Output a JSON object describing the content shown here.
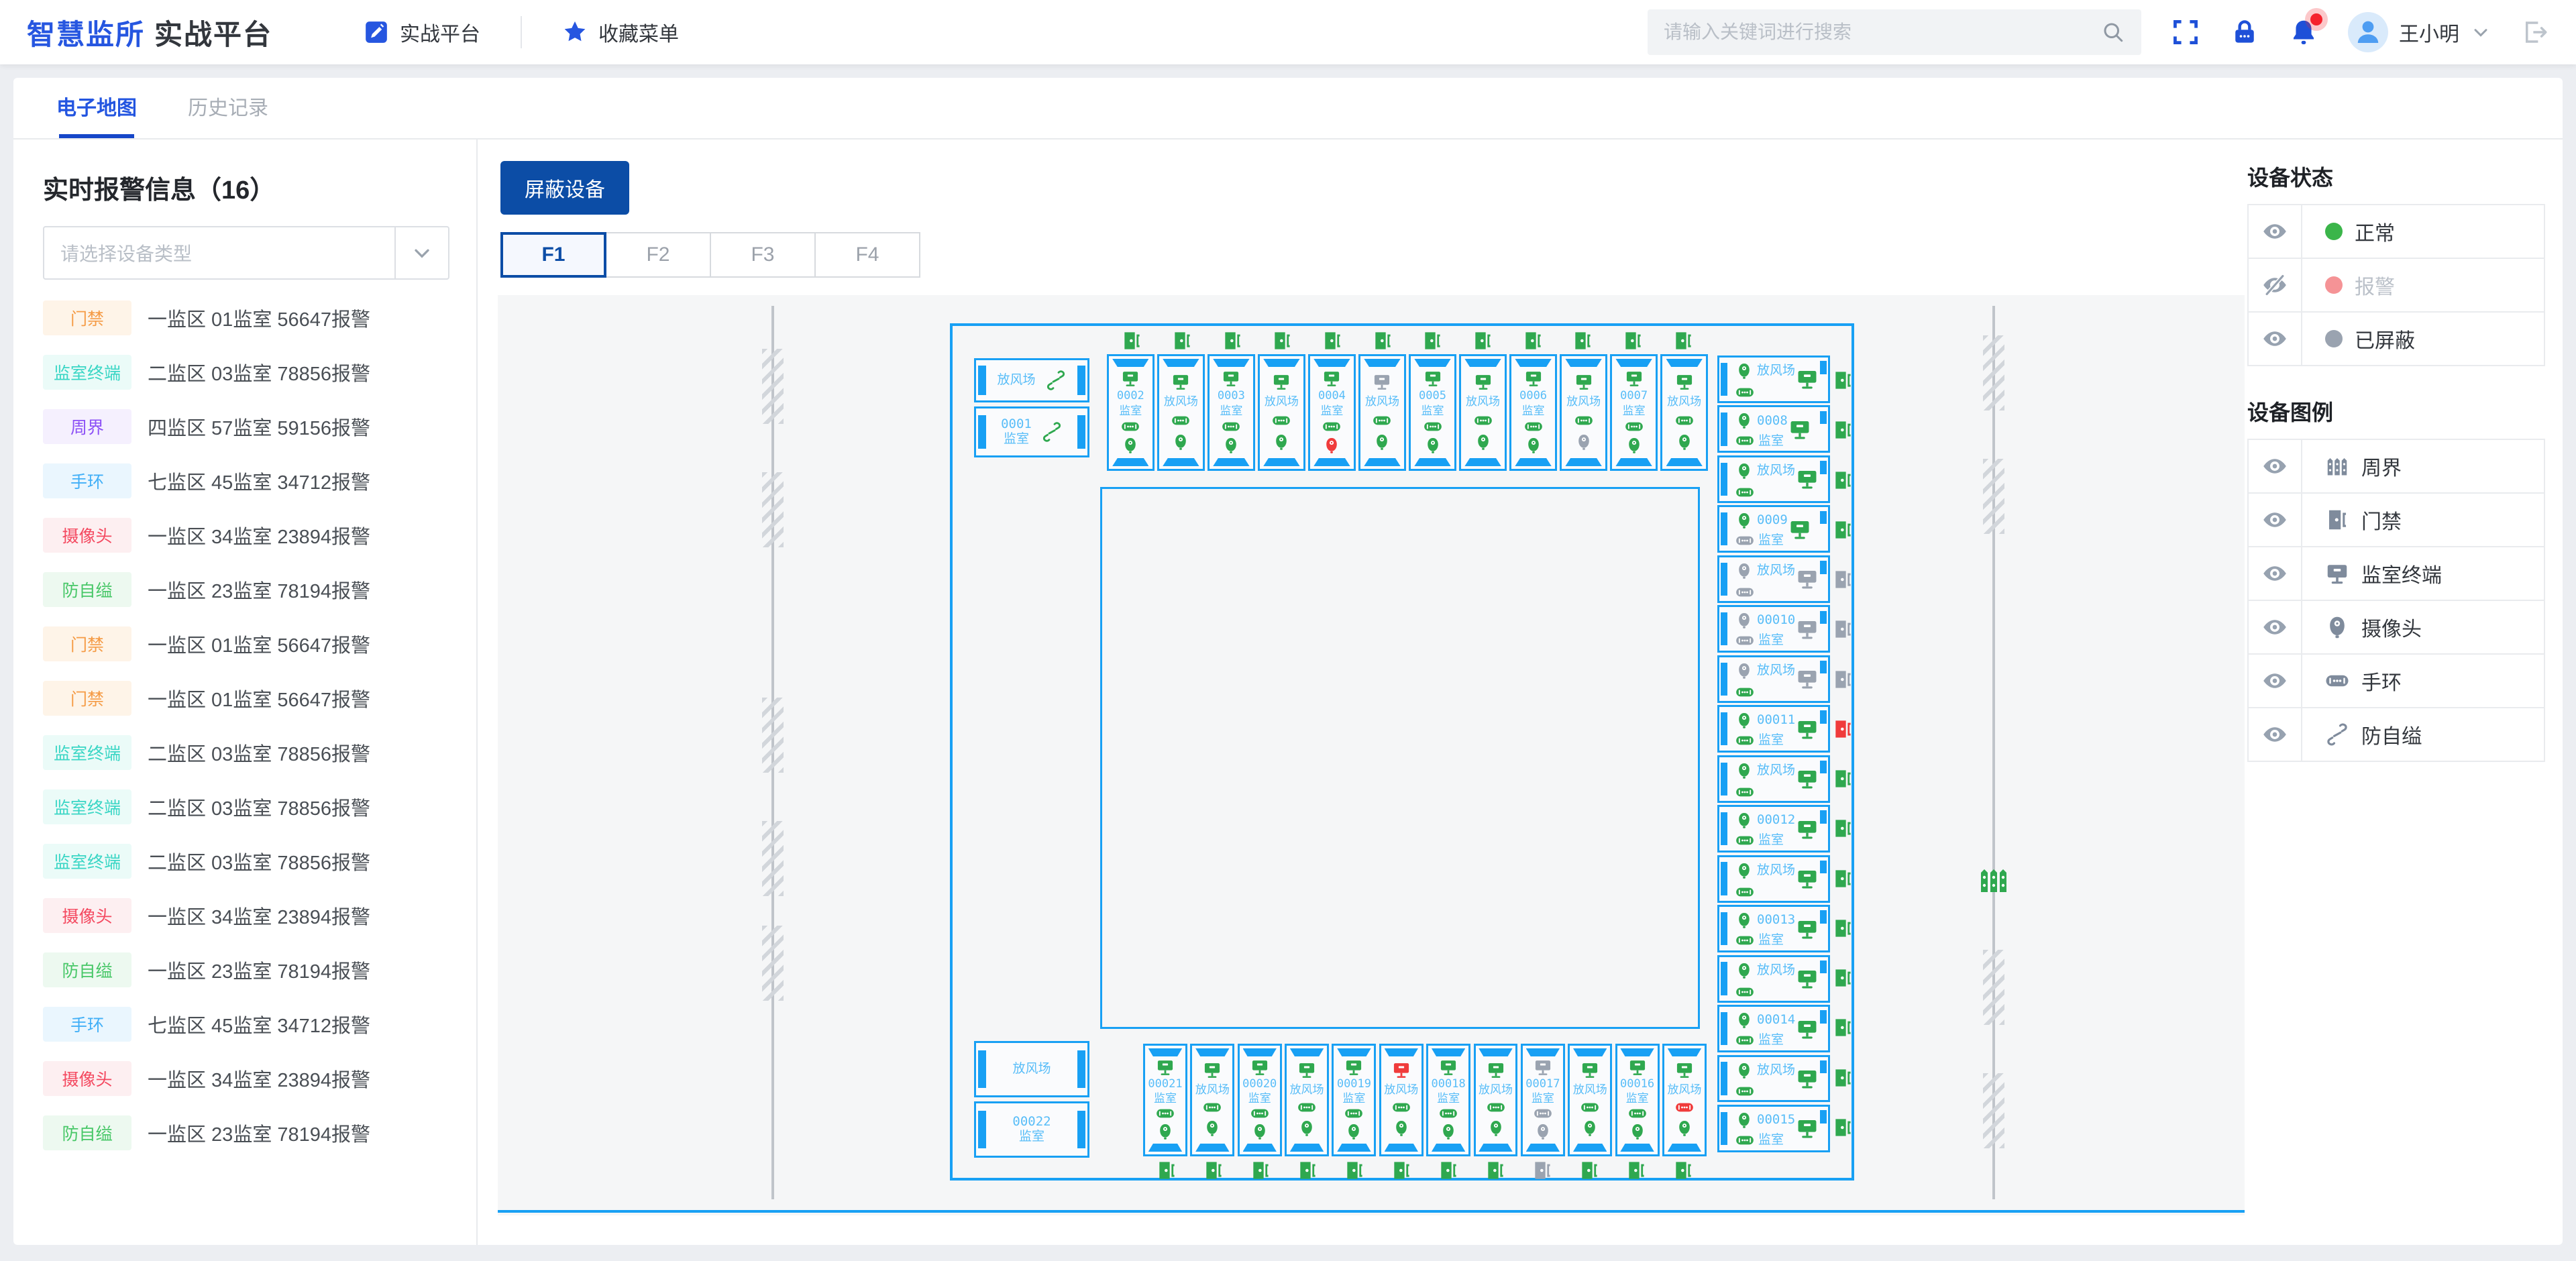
{
  "navbar": {
    "logo_primary": "智慧监所",
    "logo_secondary": "实战平台",
    "menu": [
      {
        "label": "实战平台",
        "icon": "edit-icon"
      },
      {
        "label": "收藏菜单",
        "icon": "star-icon"
      }
    ],
    "search_placeholder": "请输入关键词进行搜索",
    "user_name": "王小明"
  },
  "tabs": [
    {
      "label": "电子地图",
      "active": true
    },
    {
      "label": "历史记录",
      "active": false
    }
  ],
  "sidebar": {
    "title": "实时报警信息（16）",
    "count": 16,
    "filter_placeholder": "请选择设备类型",
    "alarms": [
      {
        "type": "门禁",
        "fg": "#F59B45",
        "bg": "#FEF4E8",
        "text": "一监区 01监室 56647报警"
      },
      {
        "type": "监室终端",
        "fg": "#3AD6C5",
        "bg": "#EBFBF8",
        "text": "二监区 03监室 78856报警"
      },
      {
        "type": "周界",
        "fg": "#8C50F6",
        "bg": "#F5F0FE",
        "text": "四监区 57监室 59156报警"
      },
      {
        "type": "手环",
        "fg": "#41AFF7",
        "bg": "#EAF6FE",
        "text": "七监区 45监室 34712报警"
      },
      {
        "type": "摄像头",
        "fg": "#F4485F",
        "bg": "#FDEFF1",
        "text": "一监区 34监室 23894报警"
      },
      {
        "type": "防自缢",
        "fg": "#47C767",
        "bg": "#EDF9F0",
        "text": "一监区 23监室 78194报警"
      },
      {
        "type": "门禁",
        "fg": "#F59B45",
        "bg": "#FEF4E8",
        "text": "一监区 01监室 56647报警"
      },
      {
        "type": "门禁",
        "fg": "#F59B45",
        "bg": "#FEF4E8",
        "text": "一监区 01监室 56647报警"
      },
      {
        "type": "监室终端",
        "fg": "#3AD6C5",
        "bg": "#EBFBF8",
        "text": "二监区 03监室 78856报警"
      },
      {
        "type": "监室终端",
        "fg": "#3AD6C5",
        "bg": "#EBFBF8",
        "text": "二监区 03监室 78856报警"
      },
      {
        "type": "监室终端",
        "fg": "#3AD6C5",
        "bg": "#EBFBF8",
        "text": "二监区 03监室 78856报警"
      },
      {
        "type": "摄像头",
        "fg": "#F4485F",
        "bg": "#FDEFF1",
        "text": "一监区 34监室 23894报警"
      },
      {
        "type": "防自缢",
        "fg": "#47C767",
        "bg": "#EDF9F0",
        "text": "一监区 23监室 78194报警"
      },
      {
        "type": "手环",
        "fg": "#41AFF7",
        "bg": "#EAF6FE",
        "text": "七监区 45监室 34712报警"
      },
      {
        "type": "摄像头",
        "fg": "#F4485F",
        "bg": "#FDEFF1",
        "text": "一监区 34监室 23894报警"
      },
      {
        "type": "防自缢",
        "fg": "#47C767",
        "bg": "#EDF9F0",
        "text": "一监区 23监室 78194报警"
      }
    ]
  },
  "toolbar": {
    "shield_button": "屏蔽设备",
    "floors": [
      "F1",
      "F2",
      "F3",
      "F4"
    ],
    "active_floor": "F1"
  },
  "map": {
    "yard_label": "放风场",
    "cell_label": "监室",
    "colors": {
      "normal": "#2FA84F",
      "alarm": "#F03B3B",
      "shielded": "#9AA3B0"
    },
    "top_left_cells": [
      {
        "kind": "yard",
        "rope": "n"
      },
      {
        "kind": "cell",
        "num": "0001",
        "rope": "n"
      }
    ],
    "bottom_left_cells": [
      {
        "kind": "yard"
      },
      {
        "kind": "cell",
        "num": "00022"
      }
    ],
    "top_row": {
      "doors": [
        "n",
        "n",
        "n",
        "n",
        "n",
        "n",
        "n",
        "n",
        "n",
        "n",
        "n",
        "n"
      ],
      "cells": [
        {
          "kind": "cell",
          "num": "0002",
          "monitor": "n",
          "band": "n",
          "camera": "n"
        },
        {
          "kind": "yard",
          "monitor": "n",
          "band": "n",
          "camera": "n"
        },
        {
          "kind": "cell",
          "num": "0003",
          "monitor": "n",
          "band": "n",
          "camera": "n"
        },
        {
          "kind": "yard",
          "monitor": "n",
          "band": "n",
          "camera": "n"
        },
        {
          "kind": "cell",
          "num": "0004",
          "monitor": "n",
          "band": "n",
          "camera": "a"
        },
        {
          "kind": "yard",
          "monitor": "s",
          "band": "n",
          "camera": "n"
        },
        {
          "kind": "cell",
          "num": "0005",
          "monitor": "n",
          "band": "n",
          "camera": "n"
        },
        {
          "kind": "yard",
          "monitor": "n",
          "band": "n",
          "camera": "n"
        },
        {
          "kind": "cell",
          "num": "0006",
          "monitor": "n",
          "band": "n",
          "camera": "n"
        },
        {
          "kind": "yard",
          "monitor": "n",
          "band": "n",
          "camera": "s"
        },
        {
          "kind": "cell",
          "num": "0007",
          "monitor": "n",
          "band": "n",
          "camera": "n"
        },
        {
          "kind": "yard",
          "monitor": "n",
          "band": "n",
          "camera": "n"
        }
      ]
    },
    "right_column": {
      "doors": [
        "n",
        "n",
        "n",
        "n",
        "s",
        "s",
        "s",
        "a",
        "n",
        "n",
        "n",
        "n",
        "n",
        "n",
        "n",
        "n"
      ],
      "cells": [
        {
          "kind": "yard",
          "monitor": "n",
          "band": "n",
          "camera": "n"
        },
        {
          "kind": "cell",
          "num": "0008",
          "monitor": "n",
          "band": "n",
          "camera": "n"
        },
        {
          "kind": "yard",
          "monitor": "n",
          "band": "n",
          "camera": "n"
        },
        {
          "kind": "cell",
          "num": "0009",
          "monitor": "n",
          "band": "s",
          "camera": "n"
        },
        {
          "kind": "yard",
          "monitor": "s",
          "band": "s",
          "camera": "s"
        },
        {
          "kind": "cell",
          "num": "00010",
          "monitor": "s",
          "band": "s",
          "camera": "s"
        },
        {
          "kind": "yard",
          "monitor": "s",
          "band": "n",
          "camera": "s"
        },
        {
          "kind": "cell",
          "num": "00011",
          "monitor": "n",
          "band": "n",
          "camera": "n"
        },
        {
          "kind": "yard",
          "monitor": "n",
          "band": "n",
          "camera": "n"
        },
        {
          "kind": "cell",
          "num": "00012",
          "monitor": "n",
          "band": "n",
          "camera": "n"
        },
        {
          "kind": "yard",
          "monitor": "n",
          "band": "n",
          "camera": "n"
        },
        {
          "kind": "cell",
          "num": "00013",
          "monitor": "n",
          "band": "n",
          "camera": "n"
        },
        {
          "kind": "yard",
          "monitor": "n",
          "band": "n",
          "camera": "n"
        },
        {
          "kind": "cell",
          "num": "00014",
          "monitor": "n",
          "band": "n",
          "camera": "n"
        },
        {
          "kind": "yard",
          "monitor": "n",
          "band": "n",
          "camera": "n"
        },
        {
          "kind": "cell",
          "num": "00015",
          "monitor": "n",
          "band": "n",
          "camera": "n"
        }
      ]
    },
    "bottom_row": {
      "doors": [
        "n",
        "n",
        "n",
        "n",
        "n",
        "n",
        "n",
        "n",
        "s",
        "n",
        "n",
        "n"
      ],
      "cells": [
        {
          "kind": "cell",
          "num": "00021",
          "monitor": "n",
          "band": "n",
          "camera": "n"
        },
        {
          "kind": "yard",
          "monitor": "n",
          "band": "n",
          "camera": "n"
        },
        {
          "kind": "cell",
          "num": "00020",
          "monitor": "n",
          "band": "n",
          "camera": "n"
        },
        {
          "kind": "yard",
          "monitor": "n",
          "band": "n",
          "camera": "n"
        },
        {
          "kind": "cell",
          "num": "00019",
          "monitor": "n",
          "band": "n",
          "camera": "n"
        },
        {
          "kind": "yard",
          "monitor": "a",
          "band": "n",
          "camera": "n"
        },
        {
          "kind": "cell",
          "num": "00018",
          "monitor": "n",
          "band": "n",
          "camera": "n"
        },
        {
          "kind": "yard",
          "monitor": "n",
          "band": "n",
          "camera": "n"
        },
        {
          "kind": "cell",
          "num": "00017",
          "monitor": "s",
          "band": "s",
          "camera": "s"
        },
        {
          "kind": "yard",
          "monitor": "n",
          "band": "n",
          "camera": "n"
        },
        {
          "kind": "cell",
          "num": "00016",
          "monitor": "n",
          "band": "n",
          "camera": "n"
        },
        {
          "kind": "yard",
          "monitor": "n",
          "band": "a",
          "camera": "n"
        }
      ]
    }
  },
  "status_panel": {
    "title": "设备状态",
    "items": [
      {
        "eye": "eye-open-icon",
        "dot": "#3BB54A",
        "label": "正常",
        "dim": false
      },
      {
        "eye": "eye-slash-icon",
        "dot": "#F59396",
        "label": "报警",
        "dim": true
      },
      {
        "eye": "eye-open-icon",
        "dot": "#9AA3B0",
        "label": "已屏蔽",
        "dim": false
      }
    ]
  },
  "legend_panel": {
    "title": "设备图例",
    "items": [
      {
        "icon": "fence-icon",
        "label": "周界"
      },
      {
        "icon": "door-icon",
        "label": "门禁"
      },
      {
        "icon": "monitor-icon",
        "label": "监室终端"
      },
      {
        "icon": "camera-icon",
        "label": "摄像头"
      },
      {
        "icon": "band-icon",
        "label": "手环"
      },
      {
        "icon": "rope-icon",
        "label": "防自缢"
      }
    ]
  }
}
